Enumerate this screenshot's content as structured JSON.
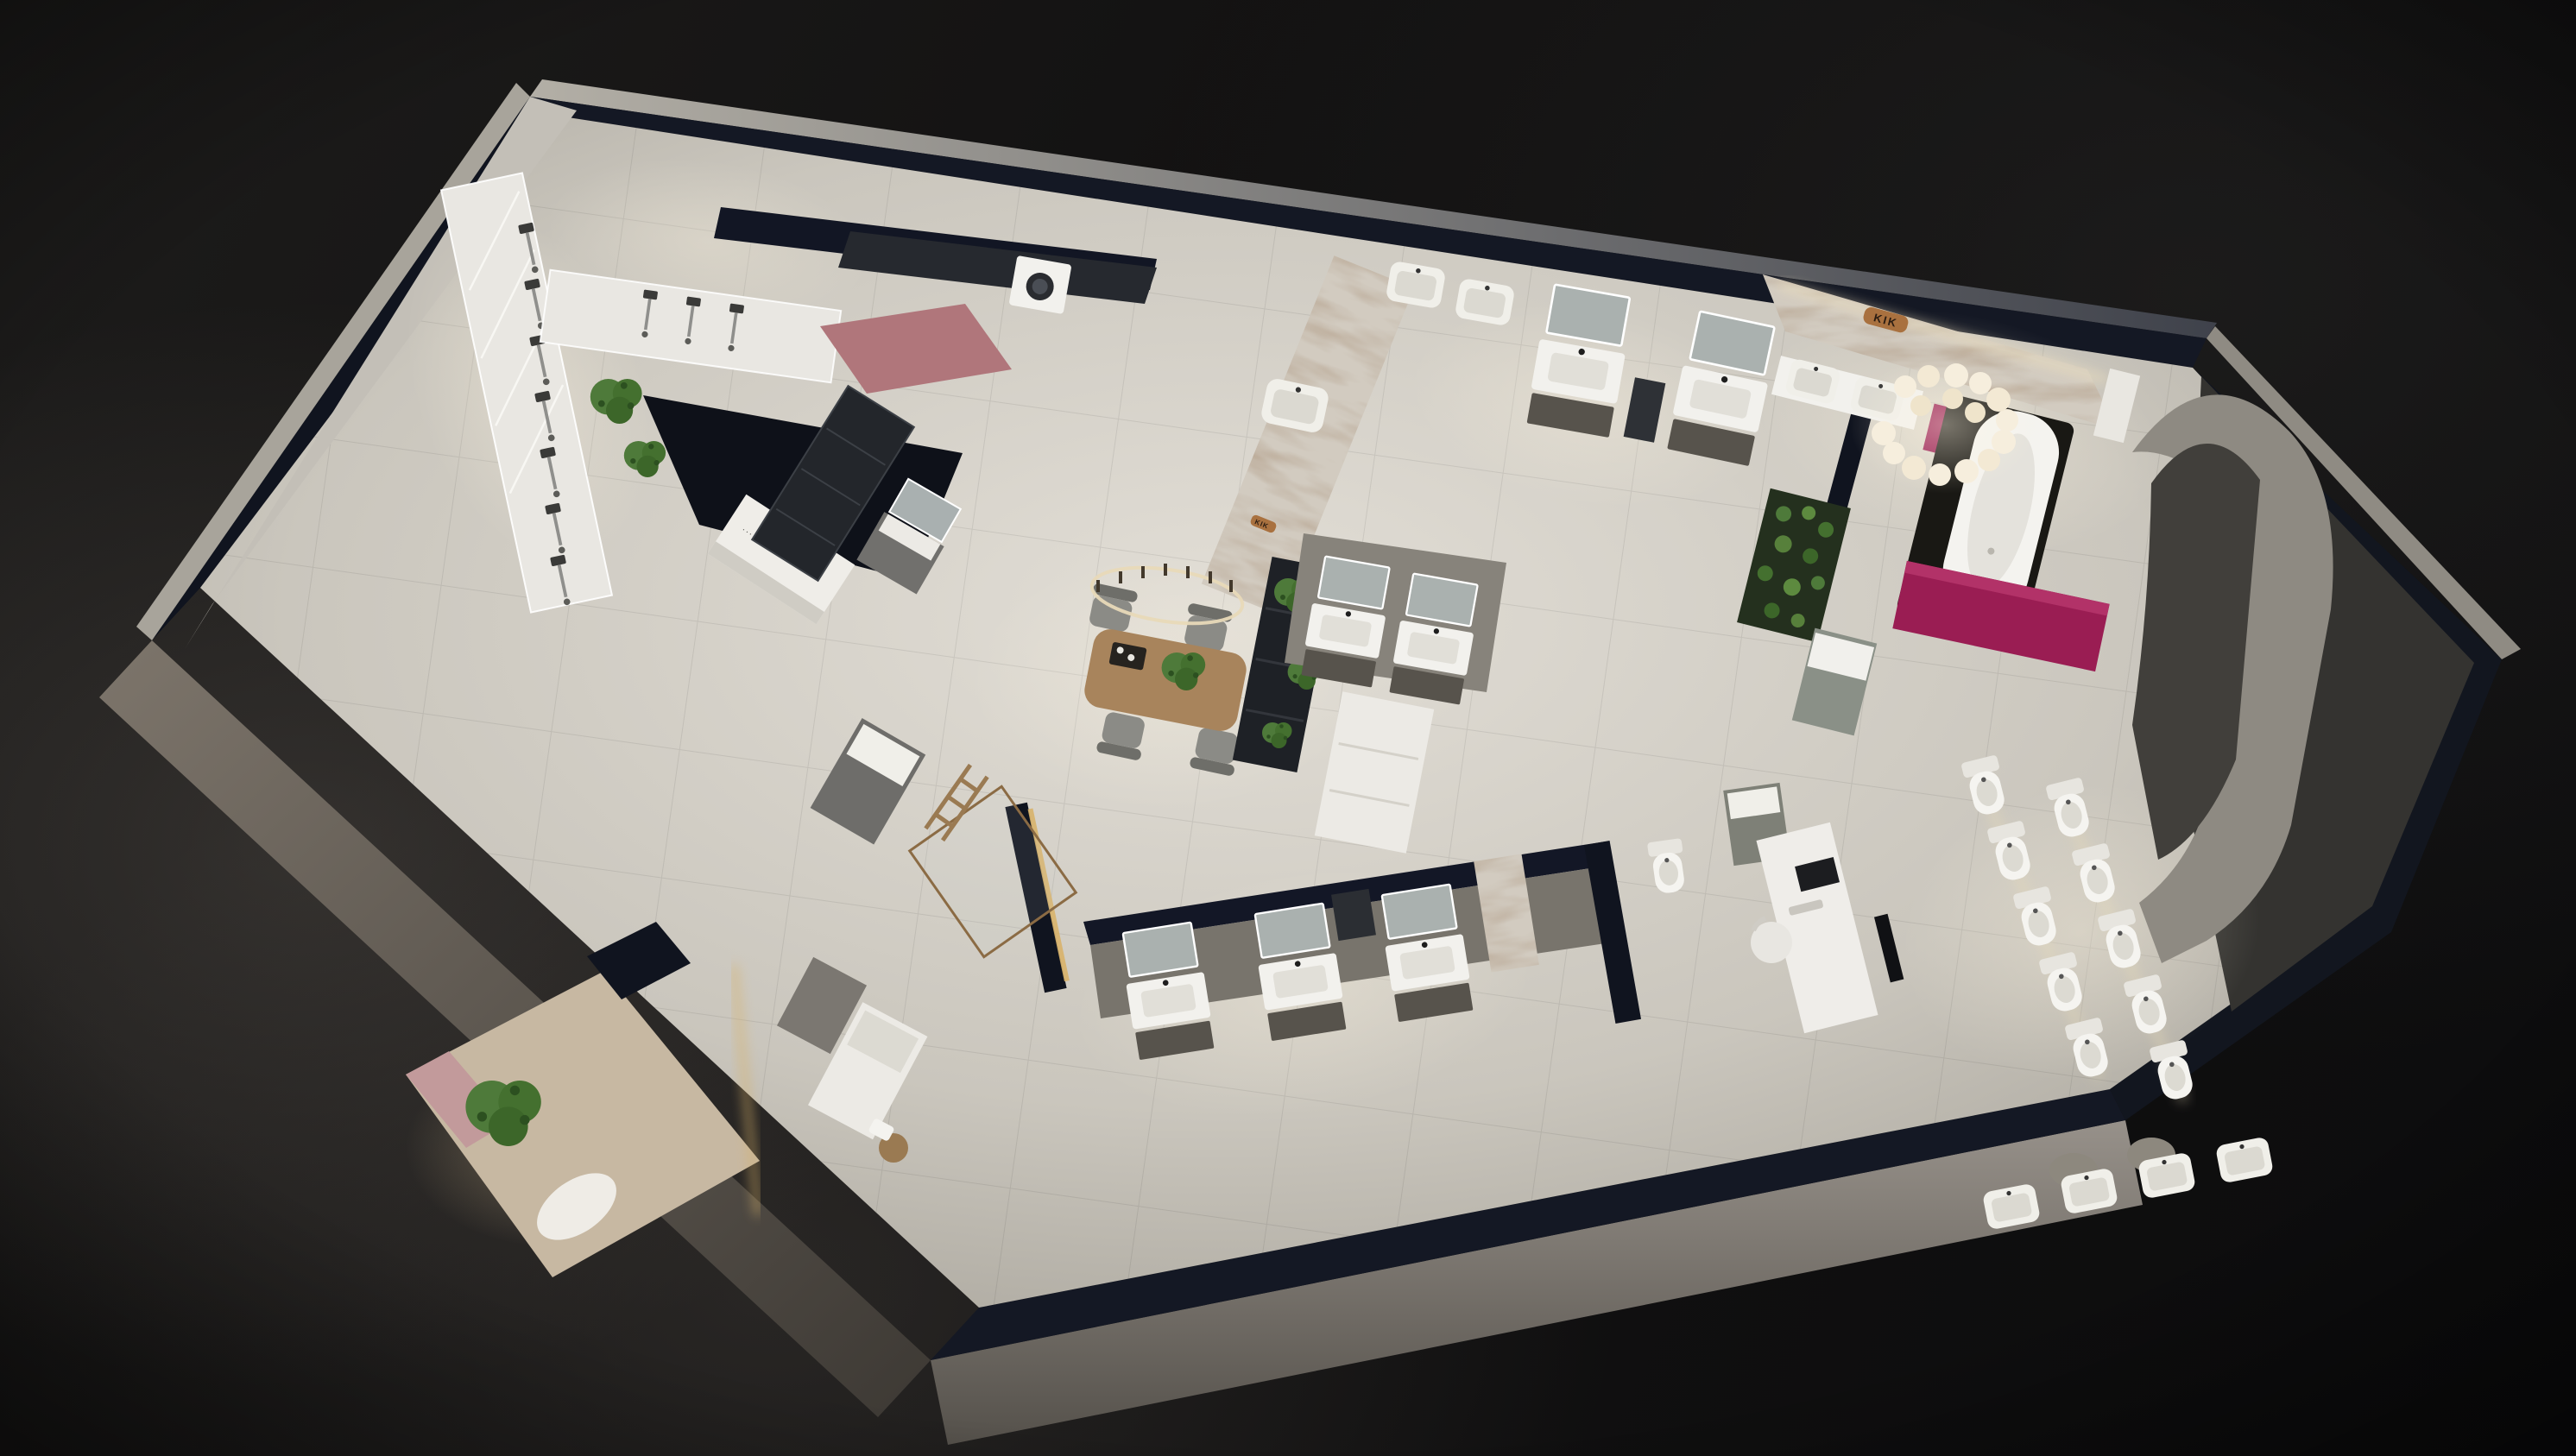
{
  "scene": {
    "type": "photorealistic 3D aerial cutaway render, night lighting",
    "subject": "bathroom and sanitary-ware showroom floor plan viewed from above at an angle",
    "logos": {
      "brand": "KIK"
    },
    "micro_label": "····· ·····",
    "colors": {
      "background": "#141312",
      "wall_navy": "#141824",
      "wall_light": "#aaa69d",
      "floor_light": "#ddd9d1",
      "floor_dark": "#a5a198",
      "accent_magenta": "#9a1d53",
      "accent_pink": "#b0767b",
      "marble": "#d2cbc0",
      "bronze": "#a9713f",
      "wood": "#a8845c",
      "plant_green": "#4e7a3a",
      "fixture_white": "#f2f1ed",
      "cabinet_gray": "#6b6b68",
      "glow_warm": "#f5e9cd"
    },
    "inventory": {
      "shower_display_columns": 10,
      "vanity_units_with_mirrors": 10,
      "wall_hung_basins": 8,
      "toilets_on_display": 10,
      "freestanding_bathtubs": 1,
      "washing_machines": 1,
      "meeting_table_chairs": 4,
      "decorative_plants": 8,
      "feature_pendant_lights": 2
    }
  }
}
